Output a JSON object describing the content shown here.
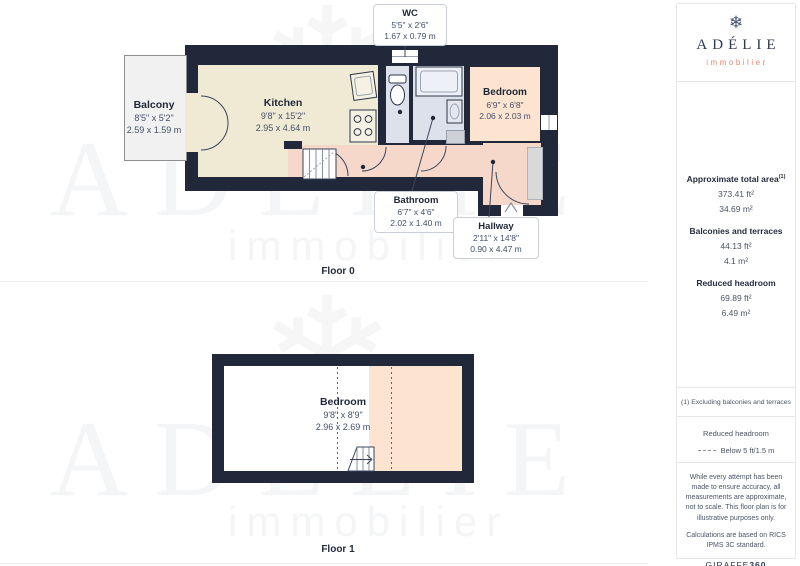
{
  "page": {
    "floor0_label": "Floor 0",
    "floor1_label": "Floor 1"
  },
  "floor0": {
    "balcony": {
      "name": "Balcony",
      "ft": "8'5\" x 5'2\"",
      "m": "2.59 x 1.59 m"
    },
    "kitchen": {
      "name": "Kitchen",
      "ft": "9'8\" x 15'2\"",
      "m": "2.95 x 4.64 m"
    },
    "wc": {
      "name": "WC",
      "ft": "5'5\" x 2'6\"",
      "m": "1.67 x 0.79 m"
    },
    "bathroom": {
      "name": "Bathroom",
      "ft": "6'7\" x 4'6\"",
      "m": "2.02 x 1.40 m"
    },
    "hallway": {
      "name": "Hallway",
      "ft": "2'11\" x 14'8\"",
      "m": "0.90 x 4.47 m"
    },
    "bedroom": {
      "name": "Bedroom",
      "ft": "6'9\" x 6'8\"",
      "m": "2.06 x 2.03 m"
    }
  },
  "floor1": {
    "bedroom": {
      "name": "Bedroom",
      "ft": "9'8\" x 8'9\"",
      "m": "2.96 x 2.69 m"
    }
  },
  "sidebar": {
    "logo": {
      "brand": "ADÉLIE",
      "tagline": "immobilier",
      "icon": "❄"
    },
    "areas": {
      "total_label": "Approximate total area",
      "total_sup": "(1)",
      "total_ft": "373.41 ft²",
      "total_m": "34.69 m²",
      "balconies_label": "Balconies and terraces",
      "balconies_ft": "44.13 ft²",
      "balconies_m": "4.1 m²",
      "headroom_label": "Reduced headroom",
      "headroom_ft": "69.89 ft²",
      "headroom_m": "6.49 m²"
    },
    "footnote": "(1) Excluding balconies and terraces",
    "legend": {
      "title": "Reduced headroom",
      "item": "Below 5 ft/1.5 m"
    },
    "disclaimer_1": "While every attempt has been made to ensure accuracy, all measurements are approximate, not to scale. This floor plan is for illustrative purposes only.",
    "disclaimer_2": "Calculations are based on RICS IPMS 3C standard.",
    "credit": {
      "normal": "GIRAFFE",
      "bold": "360"
    }
  },
  "watermark": {
    "brand": "ADÉLIE",
    "tagline": "immobilier",
    "flake": "❄"
  },
  "colors": {
    "wall": "#202839",
    "kitchen": "#f0ead5",
    "hallway": "#f5d8c9",
    "bedroom_peach": "#fce4d1",
    "wet_room_blue": "#dde1ec",
    "balcony_gray": "#f1f1f1",
    "brand_navy": "#2e3850",
    "brand_coral": "#e08973"
  }
}
